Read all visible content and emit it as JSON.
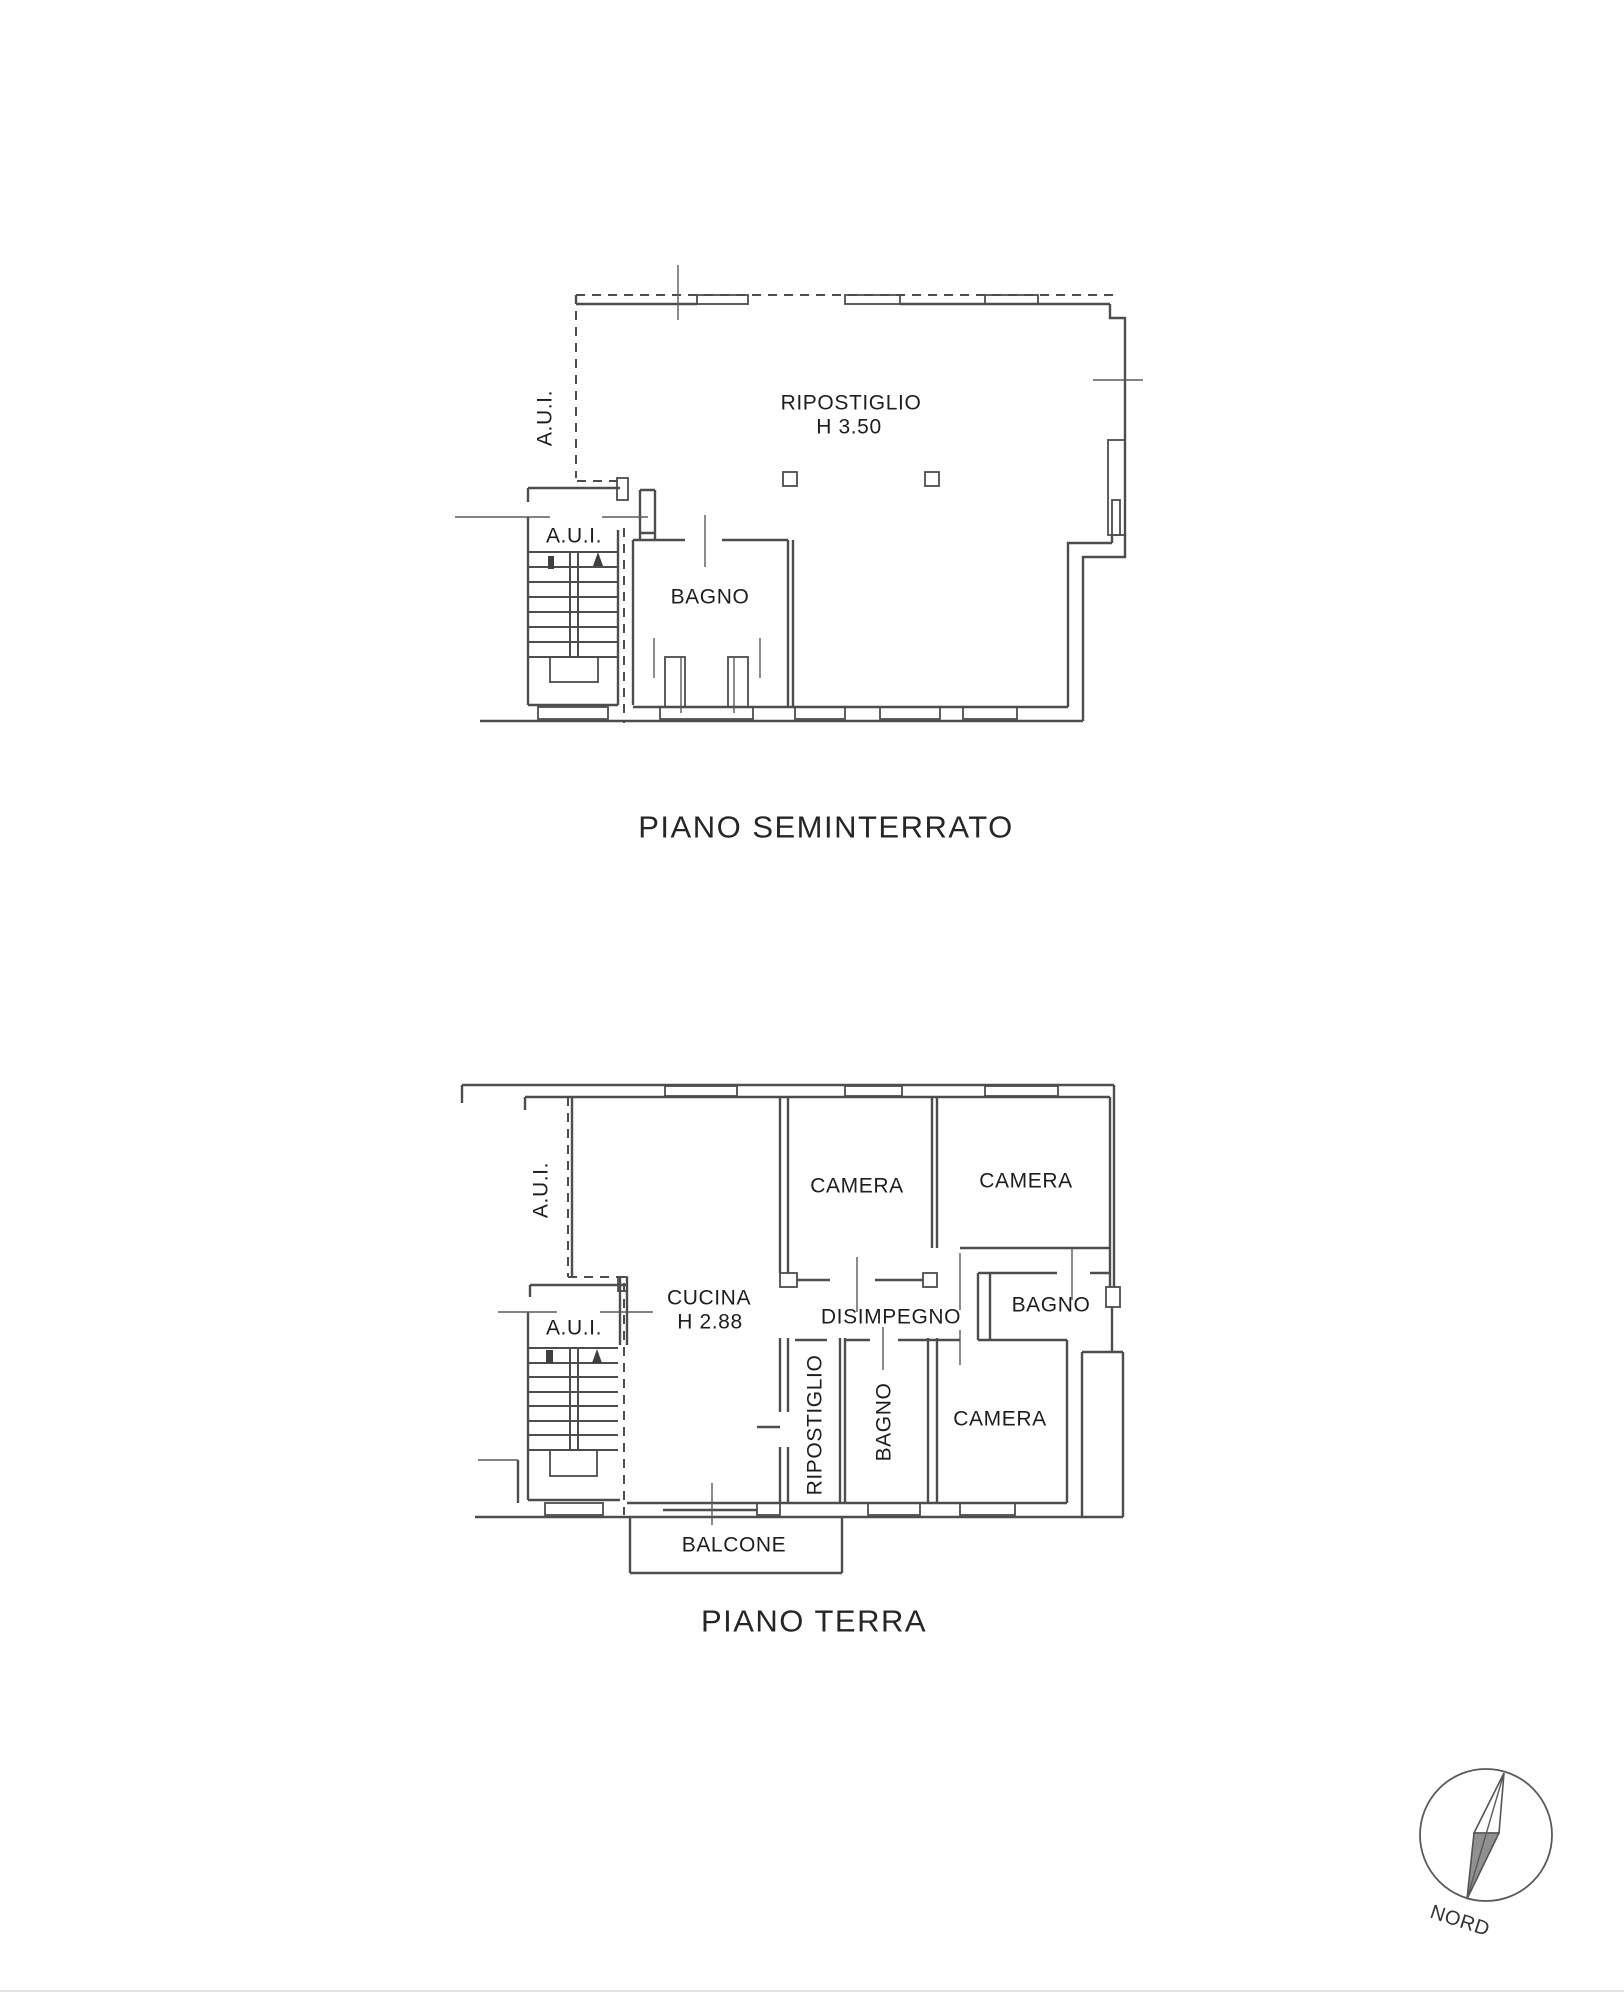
{
  "seminterrato": {
    "title": "PIANO SEMINTERRATO",
    "labels": {
      "aui_side": "A.U.I.",
      "aui_entry": "A.U.I.",
      "bagno": "BAGNO",
      "ripostiglio": "RIPOSTIGLIO",
      "ripostiglio_height": "H 3.50"
    }
  },
  "terra": {
    "title": "PIANO TERRA",
    "labels": {
      "aui_side": "A.U.I.",
      "aui_entry": "A.U.I.",
      "cucina": "CUCINA",
      "cucina_height": "H 2.88",
      "camera_top_mid": "CAMERA",
      "camera_top_right": "CAMERA",
      "camera_bottom": "CAMERA",
      "bagno_right": "BAGNO",
      "bagno_bottom": "BAGNO",
      "disimpegno": "DISIMPEGNO",
      "ripostiglio": "RIPOSTIGLIO",
      "balcone": "BALCONE"
    }
  },
  "compass": {
    "north_label": "NORD"
  }
}
